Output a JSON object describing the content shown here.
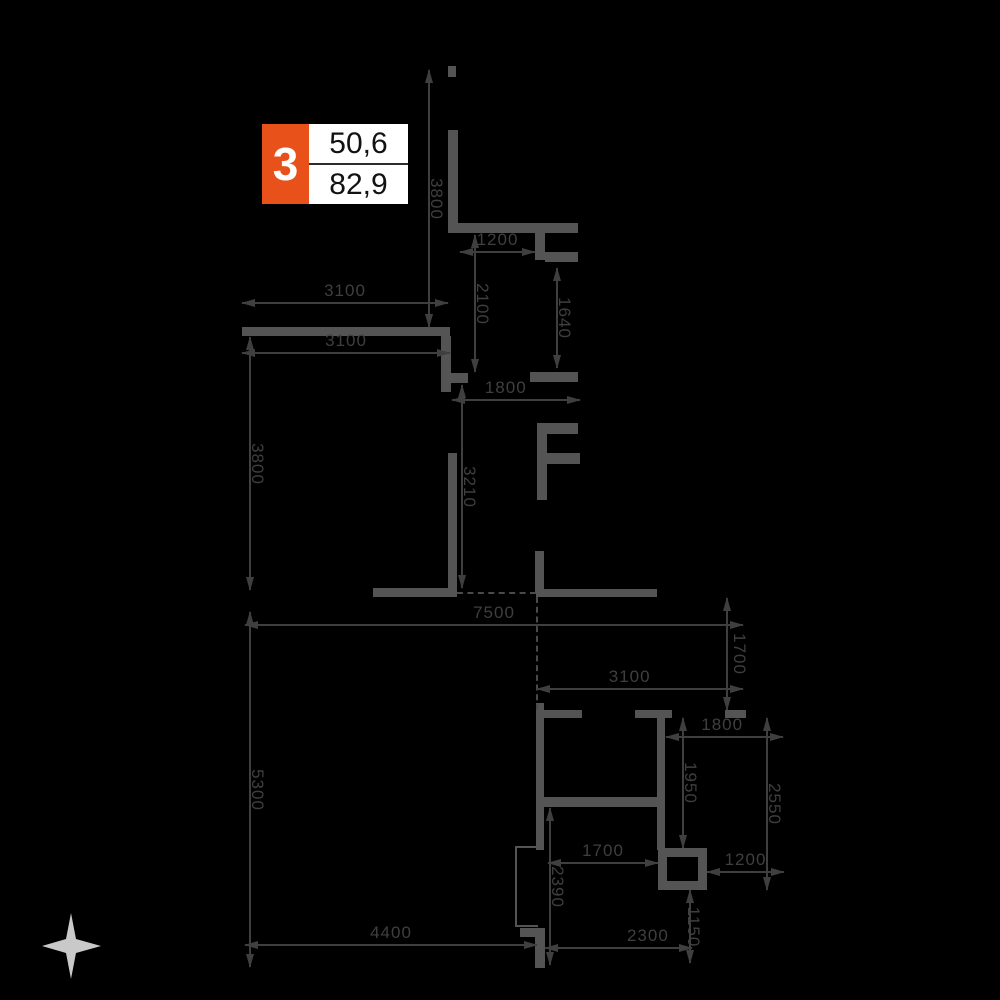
{
  "badge": {
    "number": "3",
    "value_top": "50,6",
    "value_bottom": "82,9"
  },
  "colors": {
    "background": "#000000",
    "wall": "#545454",
    "dimension": "#3f3f3f",
    "badge_accent": "#e8521a",
    "badge_background": "#ffffff",
    "compass": "#c9c9c9"
  },
  "compass": {
    "icon": "north-star-icon"
  },
  "dimensions": [
    {
      "id": "top-wall-height",
      "value": "3800",
      "orientation": "vertical"
    },
    {
      "id": "top-opening-width",
      "value": "1200",
      "orientation": "horizontal"
    },
    {
      "id": "hall-upper-height",
      "value": "2100",
      "orientation": "vertical"
    },
    {
      "id": "niche-height",
      "value": "1640",
      "orientation": "vertical"
    },
    {
      "id": "room1-width-outer",
      "value": "3100",
      "orientation": "horizontal"
    },
    {
      "id": "room1-width-inner",
      "value": "3100",
      "orientation": "horizontal"
    },
    {
      "id": "room1-height",
      "value": "3800",
      "orientation": "vertical"
    },
    {
      "id": "mid-opening-width",
      "value": "1800",
      "orientation": "horizontal"
    },
    {
      "id": "hall-lower-height",
      "value": "3210",
      "orientation": "vertical"
    },
    {
      "id": "total-width",
      "value": "7500",
      "orientation": "horizontal"
    },
    {
      "id": "lower-block-height",
      "value": "5300",
      "orientation": "vertical"
    },
    {
      "id": "right-offset-height",
      "value": "1700",
      "orientation": "vertical"
    },
    {
      "id": "room2-width",
      "value": "3100",
      "orientation": "horizontal"
    },
    {
      "id": "room2-right-width",
      "value": "1800",
      "orientation": "horizontal"
    },
    {
      "id": "room2-right-height",
      "value": "1950",
      "orientation": "vertical"
    },
    {
      "id": "right-side-height",
      "value": "2550",
      "orientation": "vertical"
    },
    {
      "id": "bath-width",
      "value": "1700",
      "orientation": "horizontal"
    },
    {
      "id": "shaft-offset-width",
      "value": "1200",
      "orientation": "horizontal"
    },
    {
      "id": "bath-height",
      "value": "2390",
      "orientation": "vertical"
    },
    {
      "id": "shaft-height",
      "value": "1150",
      "orientation": "vertical"
    },
    {
      "id": "bottom-width-right",
      "value": "2300",
      "orientation": "horizontal"
    },
    {
      "id": "bottom-width-left",
      "value": "4400",
      "orientation": "horizontal"
    }
  ]
}
